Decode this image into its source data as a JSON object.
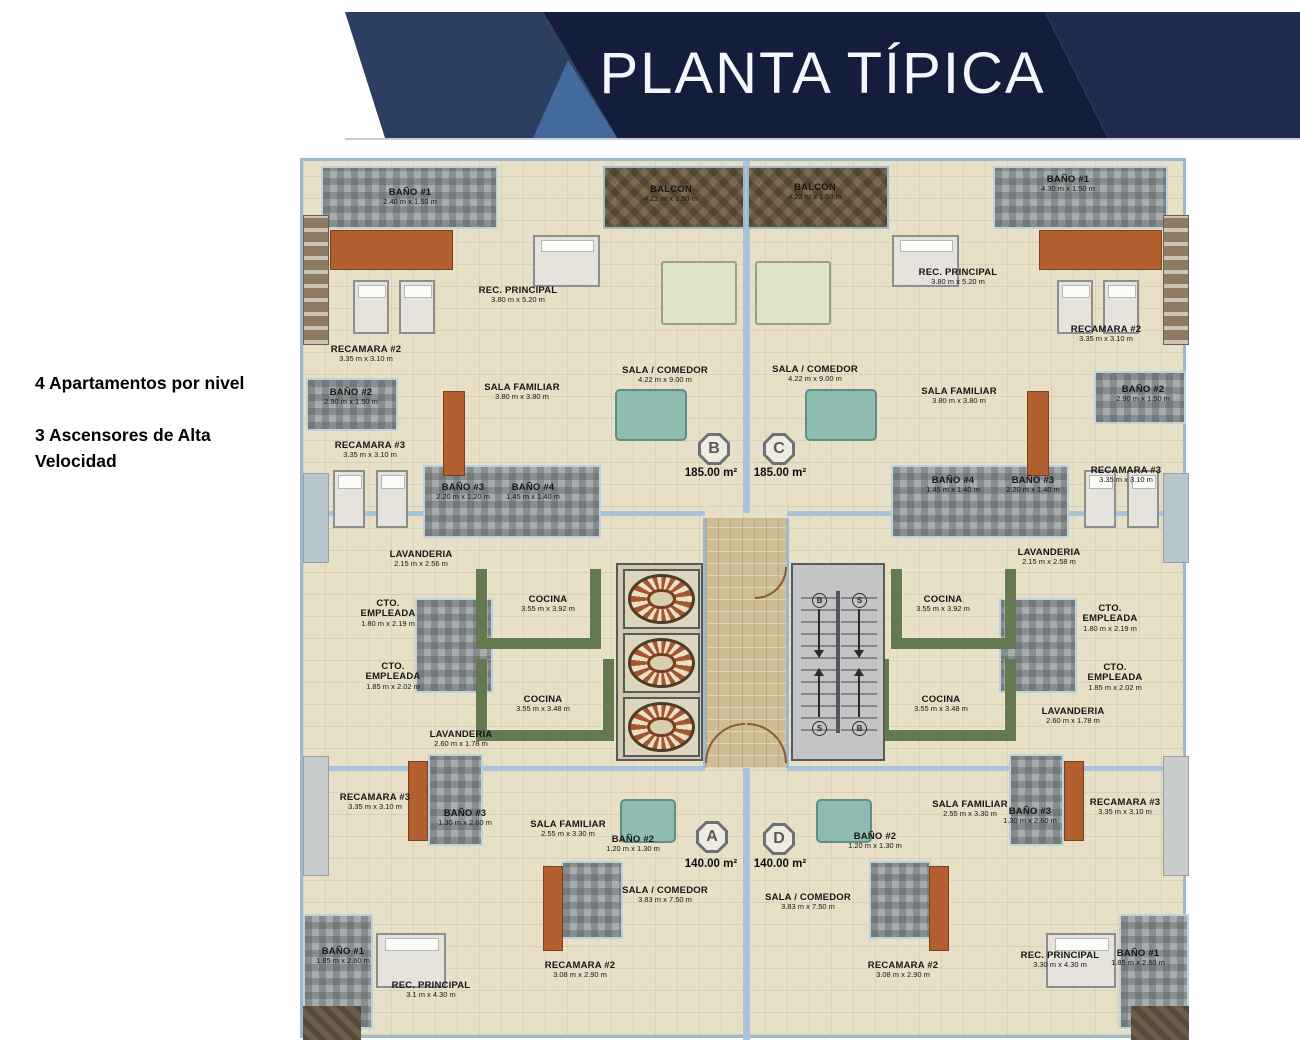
{
  "banner": {
    "title": "PLANTA TÍPICA"
  },
  "notes": {
    "line1": "4 Apartamentos por nivel",
    "line2": "3 Ascensores de Alta Velocidad"
  },
  "badges": {
    "b": {
      "letter": "B",
      "area": "185.00 m²"
    },
    "c": {
      "letter": "C",
      "area": "185.00 m²"
    },
    "a": {
      "letter": "A",
      "area": "140.00 m²"
    },
    "d": {
      "letter": "D",
      "area": "140.00 m²"
    }
  },
  "stairs": {
    "markers": [
      "B",
      "S",
      "S",
      "B"
    ]
  },
  "palette": {
    "banner_dark": "#141e3c",
    "banner_medium": "#2c3f60",
    "banner_right": "#1f2c50",
    "banner_triangle": "#44699c",
    "floor_cream": "#e7e0c7",
    "wall_blue": "#9cb9cf",
    "bath_gray": "#a7adaf",
    "balcony_brown": "#7b6a51",
    "kitchen_green": "#64794f",
    "corridor_tan": "#cdbd95",
    "accent_terracotta": "#b25f2f"
  },
  "rooms": {
    "tl_bano1": {
      "name": "BAÑO #1",
      "dims": "2.40 m x 1.50 m"
    },
    "tl_rec_principal": {
      "name": "REC. PRINCIPAL",
      "dims": "3.80 m x 5.20 m"
    },
    "tl_recamara2": {
      "name": "RECAMARA #2",
      "dims": "3.35 m x 3.10 m"
    },
    "tl_bano2": {
      "name": "BAÑO #2",
      "dims": "2.90 m x 1.50 m"
    },
    "tl_recamara3": {
      "name": "RECAMARA #3",
      "dims": "3.35 m x 3.10 m"
    },
    "tl_sala_familiar": {
      "name": "SALA FAMILIAR",
      "dims": "3.80 m x 3.80 m"
    },
    "tl_bano3": {
      "name": "BAÑO #3",
      "dims": "2.20 m x 1.20 m"
    },
    "tl_bano4": {
      "name": "BAÑO #4",
      "dims": "1.45 m x 1.40 m"
    },
    "tl_lavanderia": {
      "name": "LAVANDERIA",
      "dims": "2.15 m x 2.56 m"
    },
    "tl_cto_empleada": {
      "name": "CTO. EMPLEADA",
      "dims": "1.80 m x 2.19 m"
    },
    "tl_cocina": {
      "name": "COCINA",
      "dims": "3.55 m x 3.92 m"
    },
    "tl_balcon": {
      "name": "BALCON",
      "dims": "4.22 m x 1.50 m"
    },
    "tl_sala_comedor": {
      "name": "SALA / COMEDOR",
      "dims": "4.22 m x 9.00 m"
    },
    "bl_cto_empleada": {
      "name": "CTO. EMPLEADA",
      "dims": "1.85 m x 2.02 m"
    },
    "bl_cocina": {
      "name": "COCINA",
      "dims": "3.55 m x 3.48 m"
    },
    "bl_lavanderia": {
      "name": "LAVANDERIA",
      "dims": "2.60 m x 1.78 m"
    },
    "bl_recamara3": {
      "name": "RECAMARA #3",
      "dims": "3.35 m x 3.10 m"
    },
    "bl_bano3": {
      "name": "BAÑO #3",
      "dims": "1.30 m x 2.60 m"
    },
    "bl_sala_familiar": {
      "name": "SALA FAMILIAR",
      "dims": "2.55 m x 3.30 m"
    },
    "bl_bano2": {
      "name": "BAÑO #2",
      "dims": "1.20 m x 1.30 m"
    },
    "bl_sala_comedor": {
      "name": "SALA / COMEDOR",
      "dims": "3.83 m x 7.50 m"
    },
    "bl_recamara2": {
      "name": "RECAMARA #2",
      "dims": "3.08 m x 2.90 m"
    },
    "bl_rec_principal": {
      "name": "REC. PRINCIPAL",
      "dims": "3.1 m x 4.30 m"
    },
    "bl_bano1": {
      "name": "BAÑO #1",
      "dims": "1.85 m x 2.60 m"
    },
    "tr_bano1": {
      "name": "BAÑO #1",
      "dims": "4.30 m x 1.50 m"
    },
    "tr_rec_principal": {
      "name": "REC. PRINCIPAL",
      "dims": "3.80 m x 5.20 m"
    },
    "tr_recamara2": {
      "name": "RECAMARA #2",
      "dims": "3.35 m x 3.10 m"
    },
    "tr_sala_familiar": {
      "name": "SALA FAMILIAR",
      "dims": "3.80 m x 3.80 m"
    },
    "tr_bano2": {
      "name": "BAÑO #2",
      "dims": "2.90 m x 1.50 m"
    },
    "tr_bano4": {
      "name": "BAÑO #4",
      "dims": "1.45 m x 1.40 m"
    },
    "tr_bano3": {
      "name": "BAÑO #3",
      "dims": "2.20 m x 1.40 m"
    },
    "tr_recamara3": {
      "name": "RECAMARA #3",
      "dims": "3.35 m x 3.10 m"
    },
    "tr_balcon": {
      "name": "BALCON",
      "dims": "4.22 m x 1.50 m"
    },
    "tr_sala_comedor": {
      "name": "SALA / COMEDOR",
      "dims": "4.22 m x 9.00 m"
    },
    "tr_lavanderia": {
      "name": "LAVANDERIA",
      "dims": "2.15 m x 2.58 m"
    },
    "tr_cocina": {
      "name": "COCINA",
      "dims": "3.55 m x 3.92 m"
    },
    "tr_cto_empleada": {
      "name": "CTO. EMPLEADA",
      "dims": "1.80 m x 2.19 m"
    },
    "br_cto_empleada": {
      "name": "CTO. EMPLEADA",
      "dims": "1.85 m x 2.02 m"
    },
    "br_cocina": {
      "name": "COCINA",
      "dims": "3.55 m x 3.48 m"
    },
    "br_lavanderia": {
      "name": "LAVANDERIA",
      "dims": "2.60 m x 1.78 m"
    },
    "br_sala_familiar": {
      "name": "SALA FAMILIAR",
      "dims": "2.55 m x 3.30 m"
    },
    "br_bano3": {
      "name": "BAÑO #3",
      "dims": "1.30 m x 2.60 m"
    },
    "br_recamara3": {
      "name": "RECAMARA #3",
      "dims": "3.35 m x 3.10 m"
    },
    "br_bano2": {
      "name": "BAÑO #2",
      "dims": "1.20 m x 1.30 m"
    },
    "br_sala_comedor": {
      "name": "SALA / COMEDOR",
      "dims": "3.83 m x 7.50 m"
    },
    "br_recamara2": {
      "name": "RECAMARA #2",
      "dims": "3.08 m x 2.90 m"
    },
    "br_rec_principal": {
      "name": "REC. PRINCIPAL",
      "dims": "3.30 m x 4.30 m"
    },
    "br_bano1": {
      "name": "BAÑO #1",
      "dims": "1.85 m x 2.60 m"
    }
  }
}
